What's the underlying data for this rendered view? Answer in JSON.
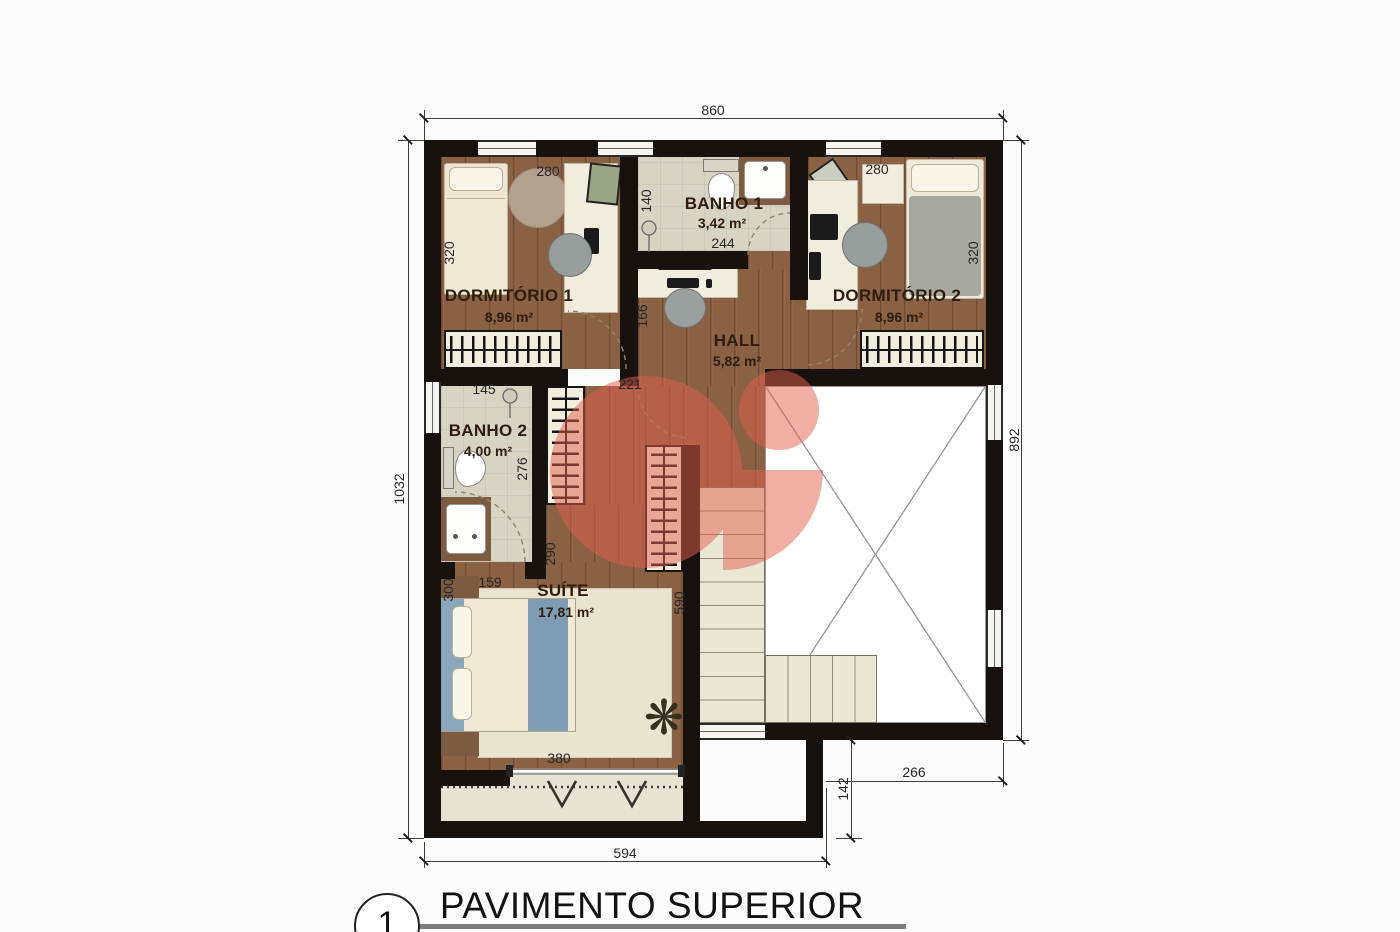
{
  "plan": {
    "sheet": {
      "number": "1",
      "title": "PAVIMENTO SUPERIOR"
    },
    "rooms": {
      "dormitorio1": {
        "name": "DORMITÓRIO 1",
        "area": "8,96 m²"
      },
      "banho1": {
        "name": "BANHO 1",
        "area": "3,42 m²"
      },
      "dormitorio2": {
        "name": "DORMITÓRIO 2",
        "area": "8,96 m²"
      },
      "hall": {
        "name": "HALL",
        "area": "5,82 m²"
      },
      "banho2": {
        "name": "BANHO 2",
        "area": "4,00 m²"
      },
      "suite": {
        "name": "SUÍTE",
        "area": "17,81 m²"
      }
    },
    "dimensions": {
      "overall_width": "860",
      "left_height": "1032",
      "right_height": "892",
      "bottom_width": "594",
      "offset_height": "142",
      "offset_width": "266",
      "dorm1_width": "280",
      "dorm1_depth": "320",
      "banho1_width": "140",
      "banho1_length": "244",
      "dorm2_width": "280",
      "dorm2_depth": "320",
      "hall_width": "166",
      "hall_opening": "221",
      "banho2_width": "145",
      "banho2_depth": "276",
      "corridor_length": "290",
      "suite_offset": "159",
      "suite_side": "300",
      "suite_depth": "590",
      "suite_width": "380"
    },
    "icons": {
      "plant": "❋"
    },
    "colors": {
      "wall": "#17120e",
      "wood_floor": "#8a6143",
      "bath_floor": "#d8d4c4",
      "furniture": "#f1edde",
      "bed_blue": "#7e9cb4",
      "stairs": "#eae6d4",
      "watermark": "#e2604e"
    }
  }
}
